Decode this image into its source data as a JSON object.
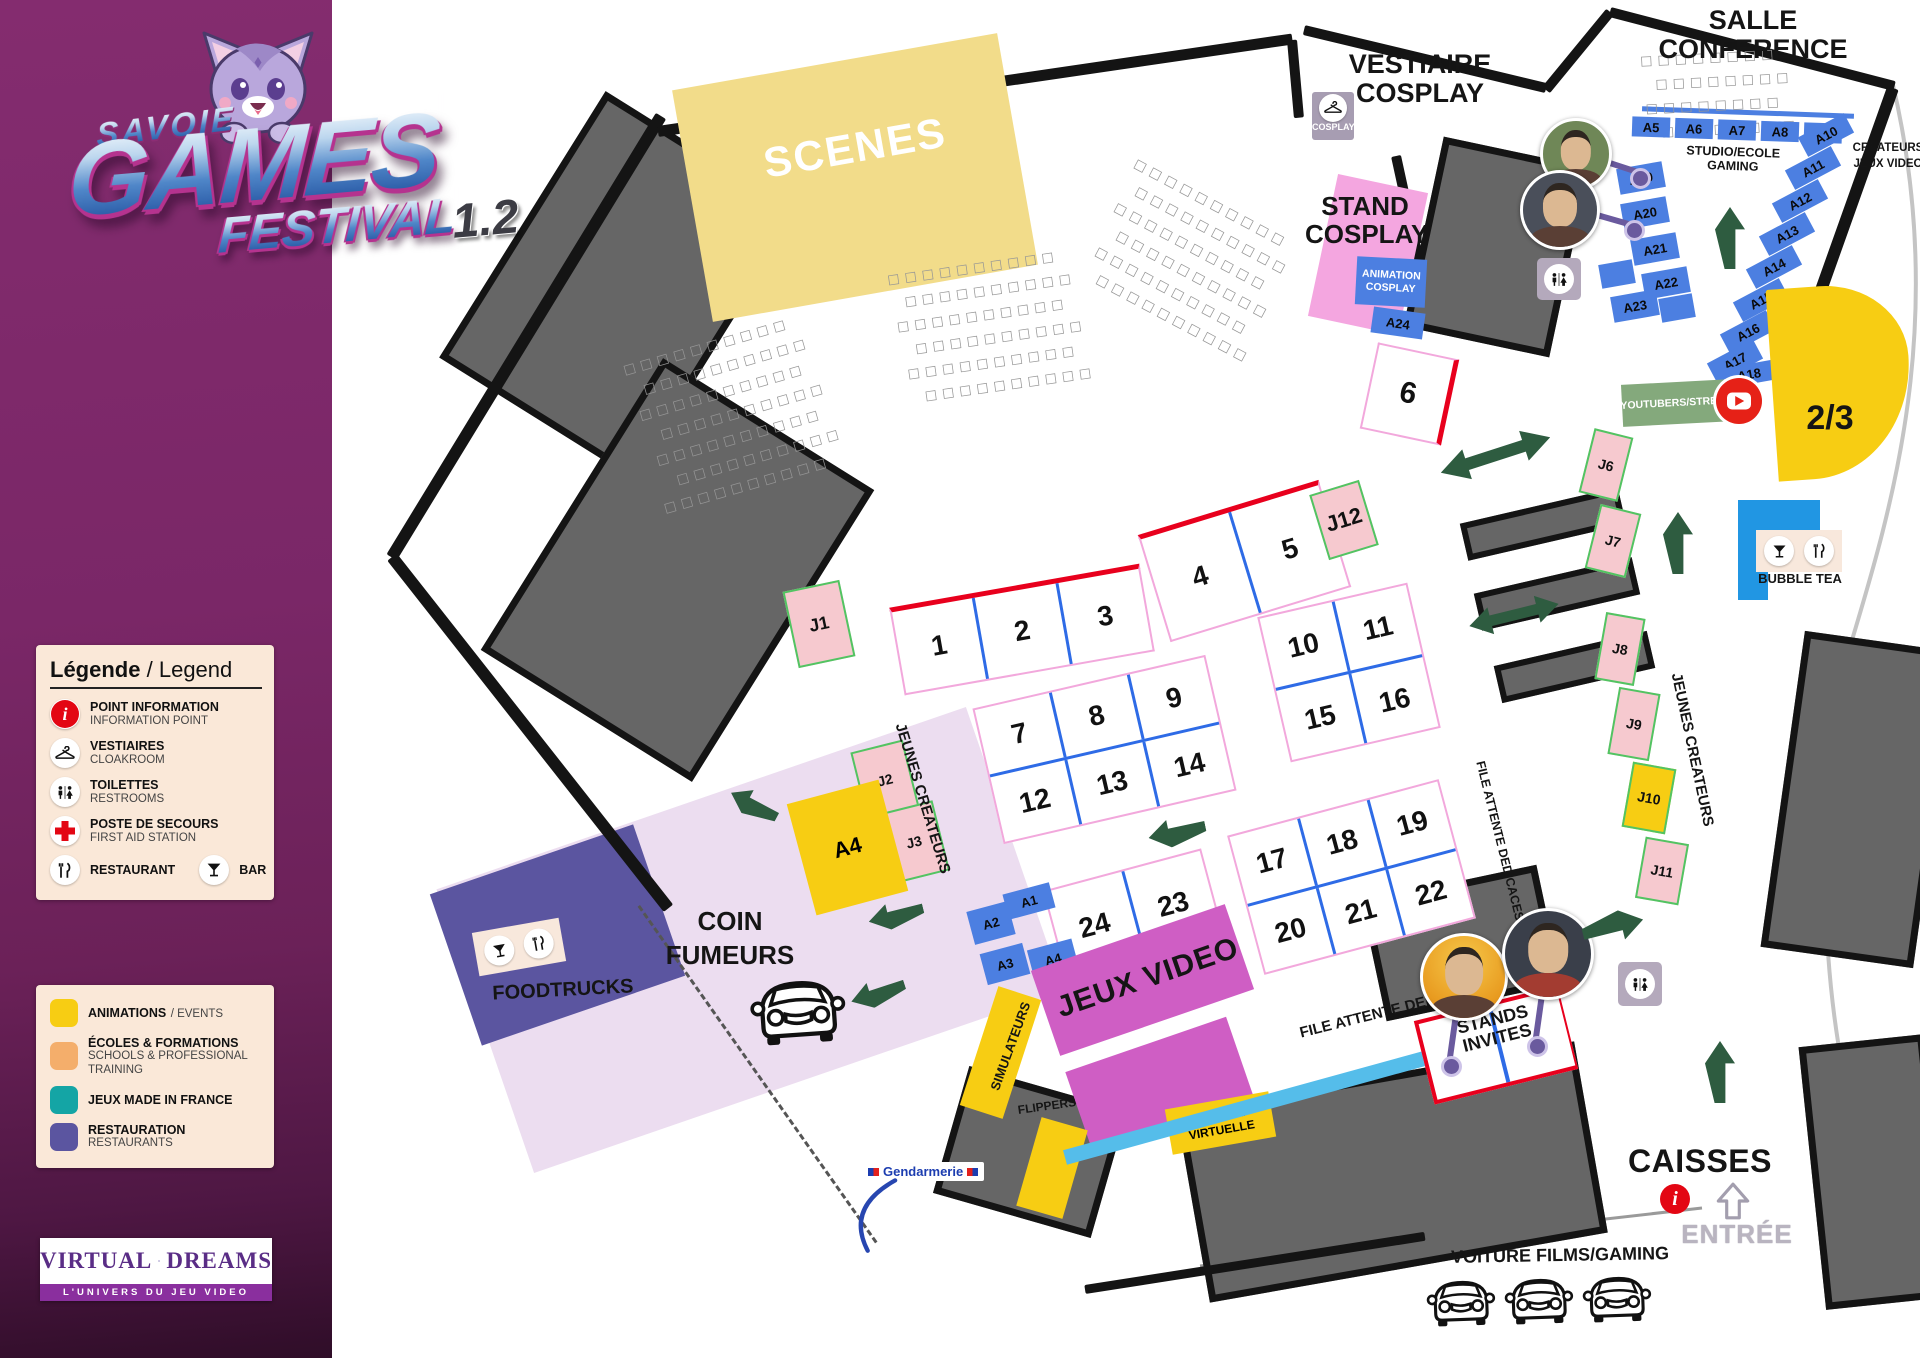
{
  "branding": {
    "region": "SAVOIE",
    "title": "GAMES",
    "subtitle": "FESTIVAL",
    "version": "1.2"
  },
  "legend": {
    "title_fr": "Légende",
    "separator": "/",
    "title_en": "Legend",
    "items": [
      {
        "fr": "POINT INFORMATION",
        "en": "INFORMATION POINT"
      },
      {
        "fr": "VESTIAIRES",
        "en": "CLOAKROOM"
      },
      {
        "fr": "TOILETTES",
        "en": "RESTROOMS"
      },
      {
        "fr": "POSTE DE SECOURS",
        "en": "FIRST AID STATION"
      },
      {
        "fr": "RESTAURANT",
        "en": ""
      },
      {
        "fr": "BAR",
        "en": ""
      }
    ]
  },
  "color_legend": [
    {
      "fr": "ANIMATIONS",
      "en": "EVENTS",
      "color": "#F7CD13"
    },
    {
      "fr": "ÉCOLES & FORMATIONS",
      "en": "SCHOOLS & PROFESSIONAL TRAINING",
      "color": "#F4AE6B"
    },
    {
      "fr": "JEUX MADE IN FRANCE",
      "en": "",
      "color": "#14A5A5"
    },
    {
      "fr": "RESTAURATION",
      "en": "RESTAURANTS",
      "color": "#5B55A0"
    }
  ],
  "partner": {
    "name_l": "VIRTUAL",
    "name_r": "DREAMS",
    "tagline": "L'UNIVERS DU JEU VIDEO"
  },
  "map": {
    "areas": {
      "scenes": "SCENES",
      "vestiaire_l1": "VESTIAIRE",
      "vestiaire_l2": "COSPLAY",
      "cosplay_badge": "COSPLAY",
      "stand_cosplay_l1": "STAND",
      "stand_cosplay_l2": "COSPLAY",
      "animation_l1": "ANIMATION",
      "animation_l2": "COSPLAY",
      "salle_l1": "SALLE",
      "salle_l2": "CONFERENCE",
      "studio": "STUDIO/ECOLE GAMING",
      "createurs_l1": "CREATEURS",
      "createurs_l2": "JEUX VIDEO",
      "youtubers": "YOUTUBERS/STREAM",
      "two_thirds": "2/3",
      "bubble_tea": "BUBBLE TEA",
      "jeunes_createurs": "JEUNES CREATEURS",
      "file_attente": "FILE ATTENTE DEDICACES",
      "jeux_video": "JEUX VIDEO",
      "simulateurs": "SIMULATEURS",
      "flippers": "FLIPPERS",
      "realite_l1": "REALITE",
      "realite_l2": "VIRTUELLE",
      "coin_l1": "COIN",
      "coin_l2": "FUMEURS",
      "foodtrucks": "FOODTRUCKS",
      "invites_l1": "STANDS",
      "invites_l2": "INVITES",
      "caisses": "CAISSES",
      "entree": "ENTRÉE",
      "voiture": "VOITURE FILMS/GAMING",
      "gendarmerie": "Gendarmerie"
    },
    "booths": {
      "b1": "1",
      "b2": "2",
      "b3": "3",
      "b4": "4",
      "b5": "5",
      "b6": "6",
      "b7": "7",
      "b8": "8",
      "b9": "9",
      "b10": "10",
      "b11": "11",
      "b12": "12",
      "b13": "13",
      "b14": "14",
      "b15": "15",
      "b16": "16",
      "b17": "17",
      "b18": "18",
      "b19": "19",
      "b20": "20",
      "b21": "21",
      "b22": "22",
      "b23": "23",
      "b24": "24"
    },
    "stands_a": {
      "a1": "A1",
      "a2": "A2",
      "a3": "A3",
      "a4": "A4",
      "a5": "A5",
      "a6": "A6",
      "a7": "A7",
      "a8": "A8",
      "a9": "A9",
      "a10": "A10",
      "a11": "A11",
      "a12": "A12",
      "a13": "A13",
      "a14": "A14",
      "a15": "A15",
      "a16": "A16",
      "a17": "A17",
      "a18": "A18",
      "a19": "A19",
      "a20": "A20",
      "a21": "A21",
      "a22": "A22",
      "a23": "A23",
      "a24": "A24"
    },
    "stands_j": {
      "j1": "J1",
      "j2": "J2",
      "j3": "J3",
      "j6": "J6",
      "j7": "J7",
      "j8": "J8",
      "j9": "J9",
      "j10": "J10",
      "j11": "J11",
      "j12": "J12"
    },
    "decor": {
      "seat_row": "□□□□□□□□□□",
      "seat_row_short": "□□□□□□□□"
    }
  }
}
